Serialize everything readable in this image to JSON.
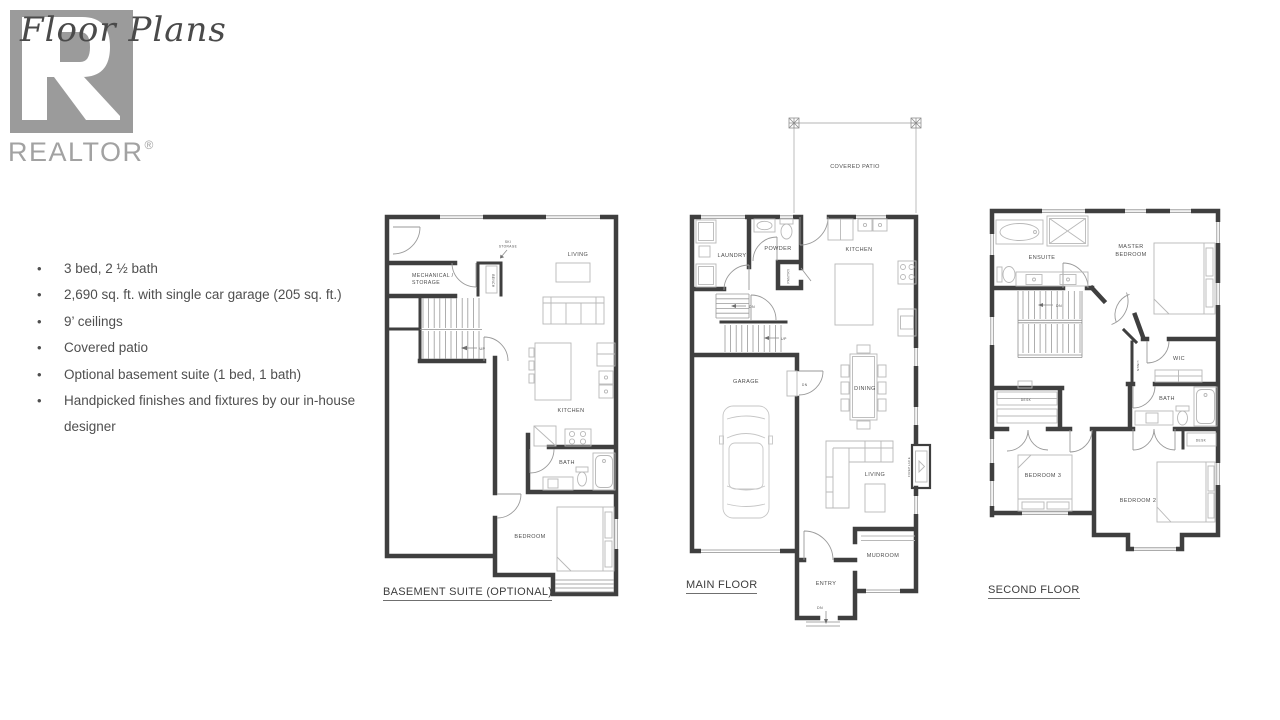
{
  "header": {
    "title": "Floor Plans",
    "brand": "REALTOR",
    "registered": "®"
  },
  "features": [
    "3 bed, 2 ½ bath",
    "2,690 sq. ft. with single car garage (205 sq. ft.)",
    "9’ ceilings",
    "Covered patio",
    "Optional basement suite (1 bed, 1 bath)",
    "Handpicked finishes and fixtures by our in-house designer"
  ],
  "plans": {
    "basement": {
      "caption": "BASEMENT SUITE (OPTIONAL)",
      "labels": {
        "mechanical_line1": "MECHANICAL /",
        "mechanical_line2": "STORAGE",
        "ski_line1": "SKI",
        "ski_line2": "STORAGE",
        "bench": "BENCH",
        "living": "LIVING",
        "kitchen": "KITCHEN",
        "bath": "BATH",
        "bedroom": "BEDROOM",
        "up": "UP"
      }
    },
    "main": {
      "caption": "MAIN FLOOR",
      "labels": {
        "covered_patio": "COVERED PATIO",
        "laundry": "LAUNDRY",
        "powder": "POWDER",
        "pantry": "PANTRY",
        "kitchen": "KITCHEN",
        "garage": "GARAGE",
        "dining": "DINING",
        "living": "LIVING",
        "fireplace": "FIREPLACE",
        "mudroom": "MUDROOM",
        "entry": "ENTRY",
        "dn_stairs": "DN",
        "up": "UP",
        "dn_garage": "DN",
        "dn_entry": "DN"
      }
    },
    "second": {
      "caption": "SECOND FLOOR",
      "labels": {
        "ensuite": "ENSUITE",
        "master_line1": "MASTER",
        "master_line2": "BEDROOM",
        "wic": "WIC",
        "linen": "LINEN",
        "bath": "BATH",
        "desk_left": "DESK",
        "desk_right": "DESK",
        "bedroom3": "BEDROOM 3",
        "bedroom2": "BEDROOM 2",
        "dn": "DN"
      }
    }
  }
}
